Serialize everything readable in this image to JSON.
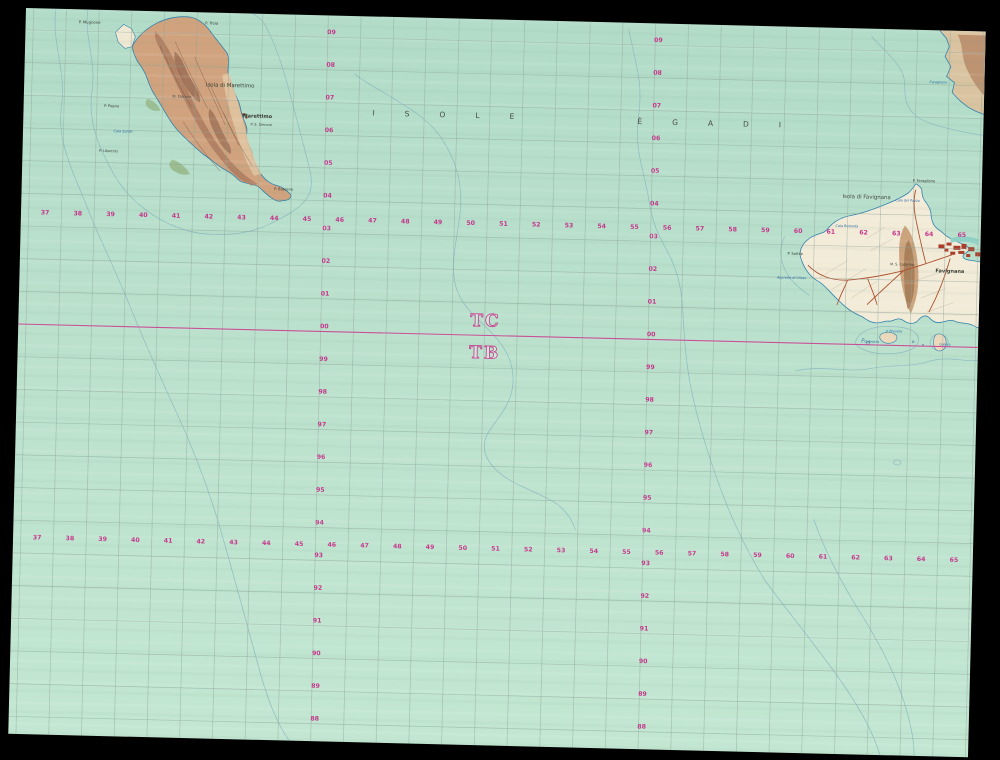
{
  "window": {
    "background": "#000000"
  },
  "map": {
    "kind": "topographic-map-photo",
    "sea_color": "#b9dfcb",
    "grid_color": "#8fa398",
    "magenta": "#c5368c",
    "archipelago_label": {
      "part1": "ISOLE",
      "part2": "ÈGADI"
    },
    "zone_boundary": {
      "above": "TC",
      "below": "TB"
    },
    "grid": {
      "eastings": [
        "37",
        "38",
        "39",
        "40",
        "41",
        "42",
        "43",
        "44",
        "45",
        "46",
        "47",
        "48",
        "49",
        "50",
        "51",
        "52",
        "53",
        "54",
        "55",
        "56",
        "57",
        "58",
        "59",
        "60",
        "61",
        "62",
        "63",
        "64",
        "65"
      ],
      "northings": [
        "09",
        "08",
        "07",
        "06",
        "05",
        "04",
        "03",
        "02",
        "01",
        "00",
        "99",
        "98",
        "97",
        "96",
        "95",
        "94",
        "93",
        "92",
        "91",
        "90",
        "89",
        "88"
      ]
    },
    "labels": [
      {
        "t": "P. Mugnone",
        "x": 64,
        "y": 14,
        "s": 3.8,
        "c": "dark"
      },
      {
        "t": "P. Troia",
        "x": 186,
        "y": 12,
        "s": 3.8,
        "c": "dark"
      },
      {
        "t": "Isola di Marettimo",
        "x": 206,
        "y": 74,
        "s": 5.4,
        "c": "dark"
      },
      {
        "t": "M. Falcone",
        "x": 158,
        "y": 86,
        "s": 3.6,
        "c": "dark"
      },
      {
        "t": "Marettimo",
        "x": 234,
        "y": 104,
        "s": 5,
        "c": "dark",
        "b": 1
      },
      {
        "t": "P. S. Simone",
        "x": 238,
        "y": 112,
        "s": 3.5,
        "c": "dark"
      },
      {
        "t": "P. Pegna",
        "x": 88,
        "y": 97,
        "s": 3.6,
        "c": "dark"
      },
      {
        "t": "Cala Sarde",
        "x": 100,
        "y": 122,
        "s": 3.5,
        "c": "blue",
        "i": 1
      },
      {
        "t": "P. Libeccio",
        "x": 86,
        "y": 142,
        "s": 3.6,
        "c": "dark"
      },
      {
        "t": "P. Bassana",
        "x": 262,
        "y": 176,
        "s": 3.6,
        "c": "dark"
      },
      {
        "t": "Isola di Favignana",
        "x": 845,
        "y": 170,
        "s": 5.4,
        "c": "dark"
      },
      {
        "t": "P. Faraglione",
        "x": 902,
        "y": 152,
        "s": 3.6,
        "c": "dark"
      },
      {
        "t": "Cala del Pozzo",
        "x": 886,
        "y": 172,
        "s": 3.4,
        "c": "blue",
        "i": 1
      },
      {
        "t": "Cala Rotonda",
        "x": 826,
        "y": 199,
        "s": 3.4,
        "c": "blue",
        "i": 1
      },
      {
        "t": "P. Sottile",
        "x": 775,
        "y": 228,
        "s": 3.6,
        "c": "dark"
      },
      {
        "t": "Approdo di Ulisse",
        "x": 772,
        "y": 252,
        "s": 3.4,
        "c": "blue",
        "i": 1
      },
      {
        "t": "M. S. Caterina",
        "x": 882,
        "y": 236,
        "s": 3.4,
        "c": "dark"
      },
      {
        "t": "Favignana",
        "x": 930,
        "y": 242,
        "s": 5,
        "c": "dark",
        "b": 1
      },
      {
        "t": "Il Preveto",
        "x": 876,
        "y": 303,
        "s": 3.4,
        "c": "blue",
        "i": 1
      },
      {
        "t": "I. Galeotta",
        "x": 852,
        "y": 314,
        "s": 3.4,
        "c": "blue",
        "i": 1
      },
      {
        "t": "Galera",
        "x": 927,
        "y": 315,
        "s": 3.4,
        "c": "blue",
        "i": 1
      },
      {
        "t": "Faraglione",
        "x": 914,
        "y": 53,
        "s": 3.4,
        "c": "blue",
        "i": 1
      }
    ]
  }
}
